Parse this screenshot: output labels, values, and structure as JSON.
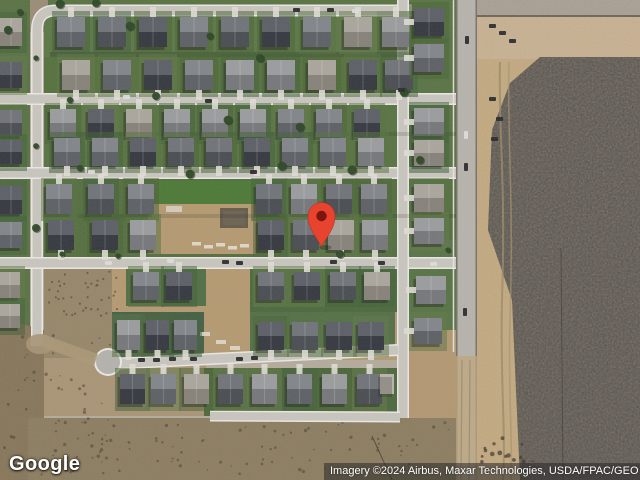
{
  "app": {
    "name": "google-maps-satellite-embed",
    "view_type": "satellite"
  },
  "logo": {
    "text": "Google"
  },
  "attribution": {
    "text": "Imagery ©2024 Airbus, Maxar Technologies, USDA/FPAC/GEO"
  },
  "marker": {
    "x": 321.5,
    "y": 216,
    "tip_y": 247,
    "head_radius": 13.5,
    "color": "#e8432f",
    "inner_color": "#7b150e"
  },
  "colors": {
    "marker_red": "#e8432f",
    "marker_inner": "#7b150e",
    "logo_color": "#ffffff",
    "attr_bg": "rgba(40,40,40,0.55)",
    "attr_text": "#ffffff",
    "base_ground": "#b3ac9c",
    "road": "#c8c5be",
    "road_edge": "#e9e7e3",
    "main_road": "#b6b3ac",
    "main_road_edge": "#78736a",
    "lawn": "#57713f",
    "lawn_bright": "#4e7a38",
    "lawn_dark": "#47614a",
    "dirt": "#b49a72",
    "dirt_light": "#c8b090",
    "gravel": "#a89f92",
    "scrub": "#8d7e62",
    "field_dark": "#554e45",
    "roof_palette": [
      "#3f434a",
      "#565a60",
      "#6b6f75",
      "#87898c",
      "#9a958b"
    ],
    "yard_palette": [
      "#4c6639",
      "#587243",
      "#62794b",
      "#46623d"
    ],
    "car_dark": "#2c2c2e",
    "car_light": "#dcdcd8",
    "tree": "#2f4a28",
    "driveway": "#dedbd4"
  }
}
